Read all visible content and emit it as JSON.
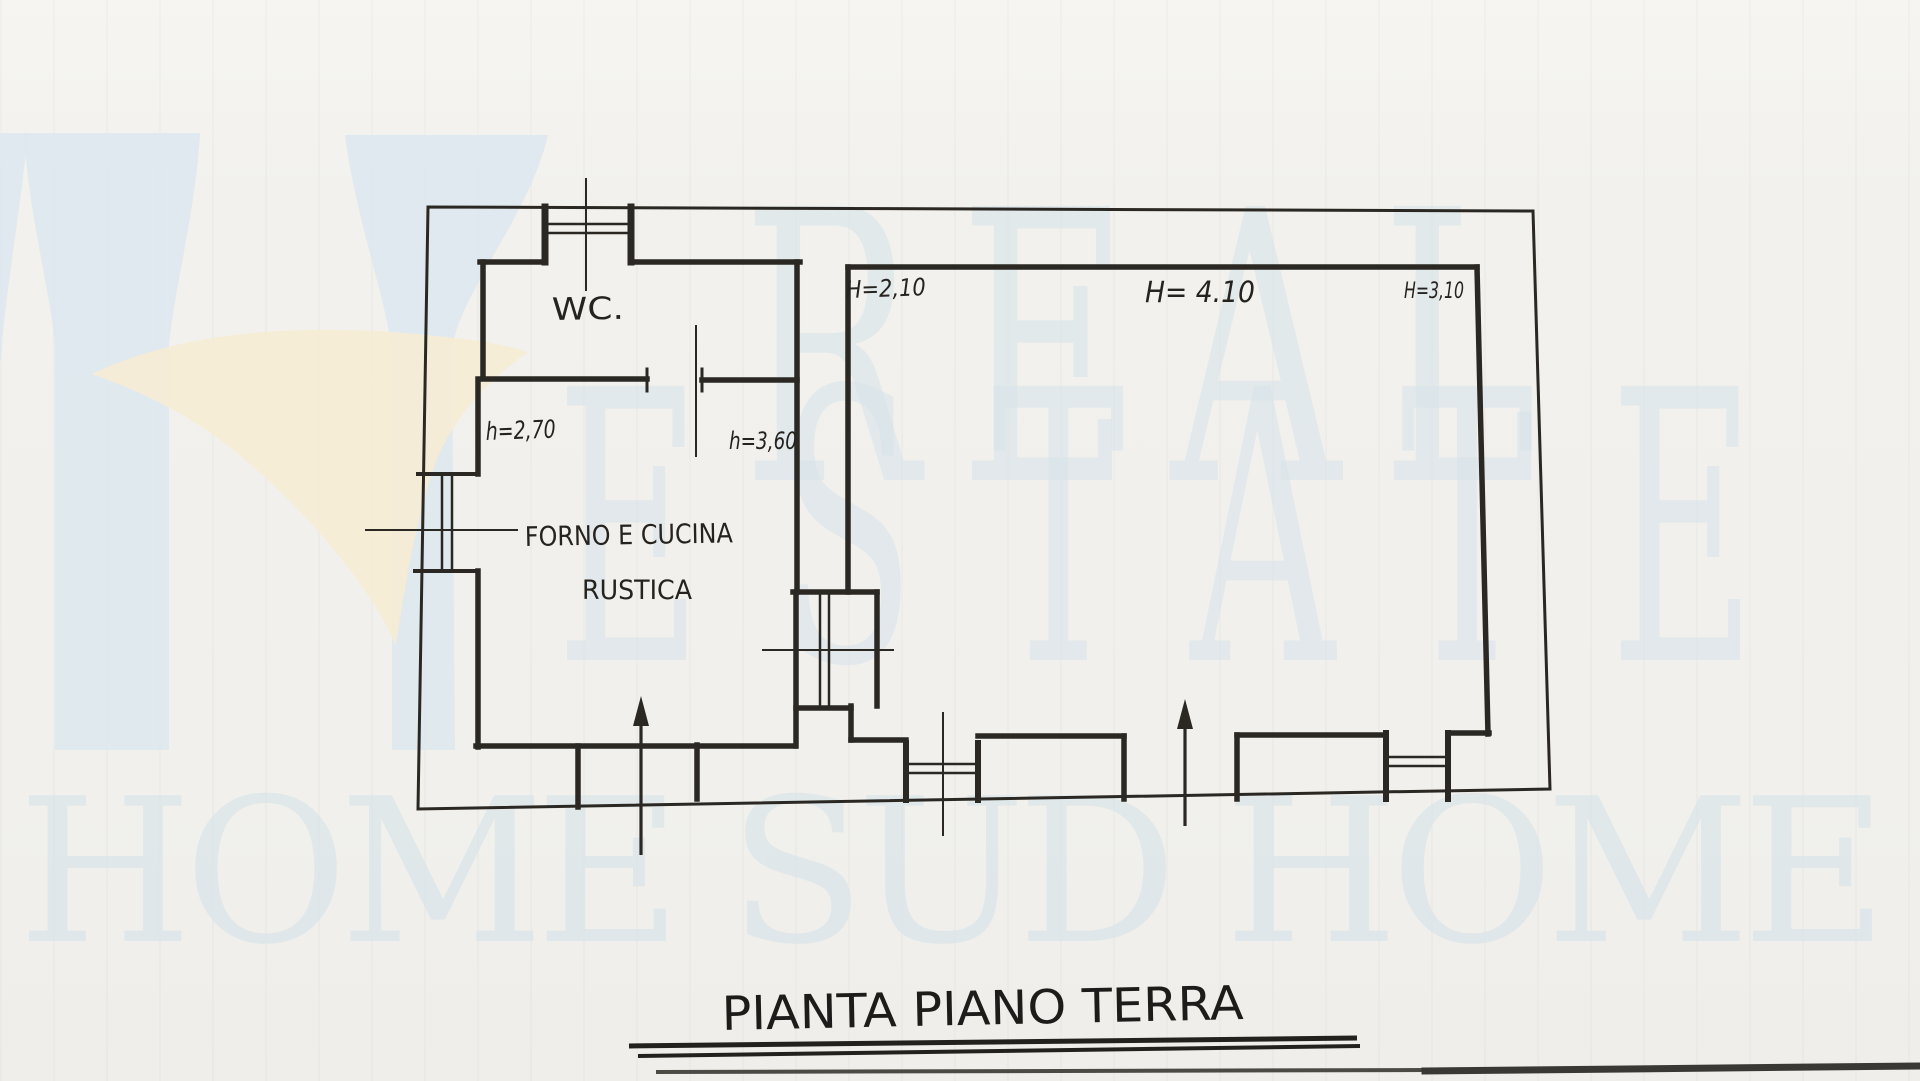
{
  "document": {
    "kind": "scanned hand-drawn floor plan",
    "title": "PIANTA PIANO TERRA"
  },
  "watermark": {
    "row1": "REAL",
    "row2": "ESTATE",
    "row3": "HOME SUD HOME",
    "text_color": "#d8e4ea",
    "logo_blue": "#dce8ee",
    "logo_cream": "#f5ecd6"
  },
  "plan": {
    "ink_color": "#2b2823",
    "paper_color": "#f3f2ee",
    "labels": {
      "wc": "WC.",
      "kitchen_line1": "FORNO E CUCINA",
      "kitchen_line2": "RUSTICA"
    },
    "heights": {
      "wc_room": "h=2,70",
      "hallway": "h=3,60",
      "main_left": "H=2,10",
      "main_center": "H= 4.10",
      "main_right": "H=3,10"
    }
  }
}
